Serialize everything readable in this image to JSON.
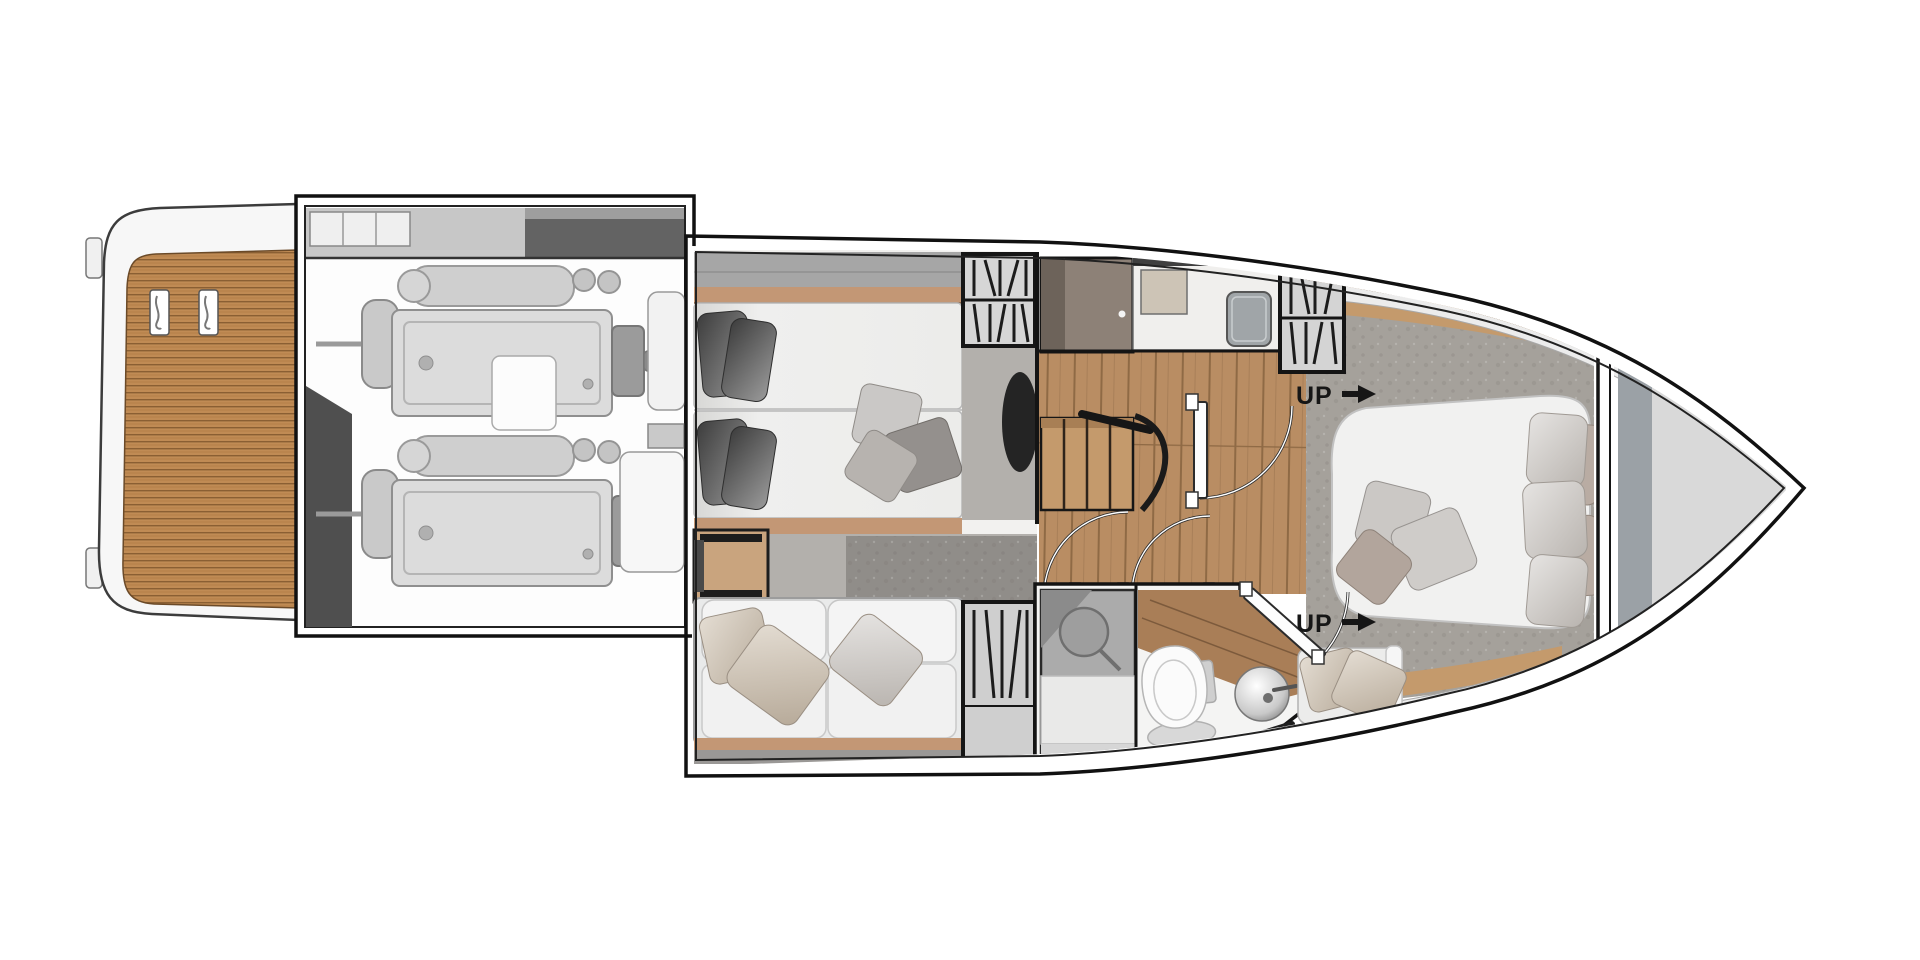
{
  "labels": {
    "up_aft": "UP",
    "up_fwd": "UP"
  },
  "icons": {
    "up_aft_arrow": "arrow-right",
    "up_fwd_arrow": "arrow-right"
  },
  "palette": {
    "background": "#ffffff",
    "hull_outline": "#141414",
    "teak": "#c08b54",
    "teak_line": "#8a5f33",
    "wood_floor": "#b98d63",
    "stair_wood": "#c49a6c",
    "trim_tan": "#c39775",
    "side_deck_gray": "#a6a6a6",
    "garage_gray": "#636363",
    "engine_gray": "#dcdcdc",
    "locker_gray": "#d4d4d4",
    "mattress_white": "#ededec",
    "sofa_white": "#f1f1f1",
    "pillow_dark": "#4b4b4b",
    "pillow_beige": "#d4cbc1",
    "carpet_mid": "#b3b0ac",
    "carpet_fwd": "#a5a19b",
    "rug_gray": "#908d89",
    "shower_gray": "#ababab",
    "counter_wood": "#a97e57",
    "bow_gray": "#d9d9d9"
  }
}
